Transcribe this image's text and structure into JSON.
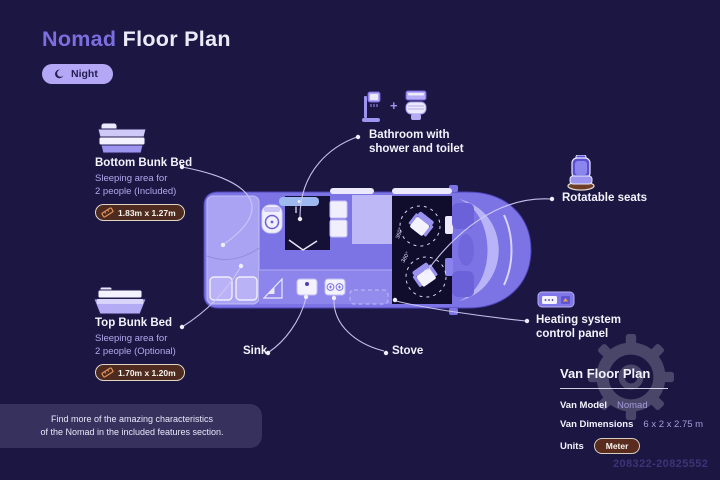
{
  "header": {
    "title_accent": "Nomad",
    "title_rest": "Floor Plan",
    "mode_toggle": {
      "label": "Night",
      "icon": "moon-icon"
    }
  },
  "callouts": {
    "bottom_bunk": {
      "title": "Bottom Bunk Bed",
      "desc_line1": "Sleeping area for",
      "desc_line2": "2 people (Included)",
      "dimensions": "1.83m x 1.27m"
    },
    "top_bunk": {
      "title": "Top Bunk Bed",
      "desc_line1": "Sleeping area for",
      "desc_line2": "2 people (Optional)",
      "dimensions": "1.70m x 1.20m"
    },
    "bathroom": {
      "line1": "Bathroom with",
      "line2": "shower and toilet",
      "plus": "+"
    },
    "rotatable_seats": {
      "label": "Rotatable seats"
    },
    "heating": {
      "line1": "Heating system",
      "line2": "control panel"
    },
    "sink": {
      "label": "Sink"
    },
    "stove": {
      "label": "Stove"
    }
  },
  "floor_plan": {
    "seat_rotation_label": "360°"
  },
  "notice": {
    "line1": "Find more of the amazing characteristics",
    "line2": "of the Nomad in the included features section."
  },
  "info_panel": {
    "title": "Van Floor Plan",
    "rows": [
      {
        "label": "Van Model",
        "value": "Nomad"
      },
      {
        "label": "Van Dimensions",
        "value": "6 x 2 x 2.75 m"
      },
      {
        "label": "Units",
        "value": "Meter"
      }
    ]
  },
  "watermark_number": "208322-20825552",
  "colors": {
    "background": "#1c1642",
    "accent_purple": "#7b6fe0",
    "pill_lavender": "#b4a8f6",
    "badge_maroon": "#4e2a1f",
    "van_body": "#7c73e4"
  }
}
